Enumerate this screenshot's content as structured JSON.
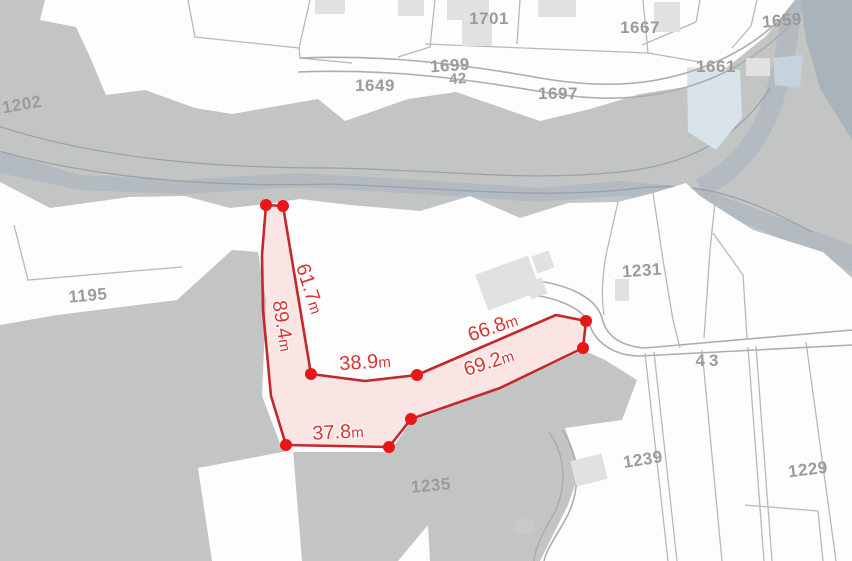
{
  "map": {
    "colors": {
      "background": "#fdfdfd",
      "parcel_gray": "#c3c4c4",
      "stream_blue_gray": "#aeb7bf",
      "water_blue": "#d8e3ec",
      "building_gray": "#e1e1e1",
      "boundary_gray": "#b9b9b9",
      "parcel_label_gray": "#9b9b9b",
      "measure_line_red": "#c2282c",
      "measure_dot_red": "#e81717",
      "measure_text_red": "#d83731"
    },
    "parcel_labels": [
      {
        "text": "1701",
        "x": 489,
        "y": 19,
        "rot": 0
      },
      {
        "text": "1667",
        "x": 640,
        "y": 28,
        "rot": 0
      },
      {
        "text": "1659",
        "x": 782,
        "y": 21,
        "rot": -5
      },
      {
        "text": "1649",
        "x": 375,
        "y": 86,
        "rot": 0
      },
      {
        "text": "1699",
        "x": 450,
        "y": 66,
        "rot": -4
      },
      {
        "text": "42",
        "x": 458,
        "y": 79,
        "rot": -4,
        "small": true
      },
      {
        "text": "1697",
        "x": 558,
        "y": 94,
        "rot": 0
      },
      {
        "text": "1661",
        "x": 716,
        "y": 67,
        "rot": 0
      },
      {
        "text": "1202",
        "x": 22,
        "y": 105,
        "rot": -10
      },
      {
        "text": "1195",
        "x": 88,
        "y": 296,
        "rot": -5
      },
      {
        "text": "1231",
        "x": 642,
        "y": 271,
        "rot": -4
      },
      {
        "text": "43",
        "x": 709,
        "y": 361,
        "rot": 0,
        "spaced": true
      },
      {
        "text": "1235",
        "x": 431,
        "y": 486,
        "rot": -5
      },
      {
        "text": "1239",
        "x": 643,
        "y": 460,
        "rot": -9
      },
      {
        "text": "1229",
        "x": 808,
        "y": 470,
        "rot": -7
      }
    ],
    "measurement": {
      "unit": "m",
      "outline": [
        [
          266,
          205
        ],
        [
          283,
          206
        ],
        [
          311,
          374
        ],
        [
          365,
          381
        ],
        [
          417,
          375
        ],
        [
          556,
          315
        ],
        [
          586,
          321
        ],
        [
          583,
          348
        ],
        [
          500,
          388
        ],
        [
          411,
          419
        ],
        [
          389,
          447
        ],
        [
          286,
          445
        ],
        [
          271,
          396
        ],
        [
          263,
          310
        ],
        [
          262,
          255
        ]
      ],
      "vertices": [
        [
          266,
          205
        ],
        [
          283,
          206
        ],
        [
          311,
          374
        ],
        [
          417,
          375
        ],
        [
          586,
          321
        ],
        [
          583,
          348
        ],
        [
          411,
          419
        ],
        [
          389,
          447
        ],
        [
          286,
          445
        ]
      ],
      "segments": [
        {
          "value": "61.7",
          "unit": "m",
          "x": 309,
          "y": 289,
          "rot": 72
        },
        {
          "value": "89.4",
          "unit": "m",
          "x": 282,
          "y": 326,
          "rot": 81
        },
        {
          "value": "38.9",
          "unit": "m",
          "x": 365,
          "y": 363,
          "rot": -4
        },
        {
          "value": "66.8",
          "unit": "m",
          "x": 493,
          "y": 328,
          "rot": -19
        },
        {
          "value": "69.2",
          "unit": "m",
          "x": 489,
          "y": 363,
          "rot": -18
        },
        {
          "value": "37.8",
          "unit": "m",
          "x": 338,
          "y": 433,
          "rot": -3
        }
      ]
    }
  }
}
